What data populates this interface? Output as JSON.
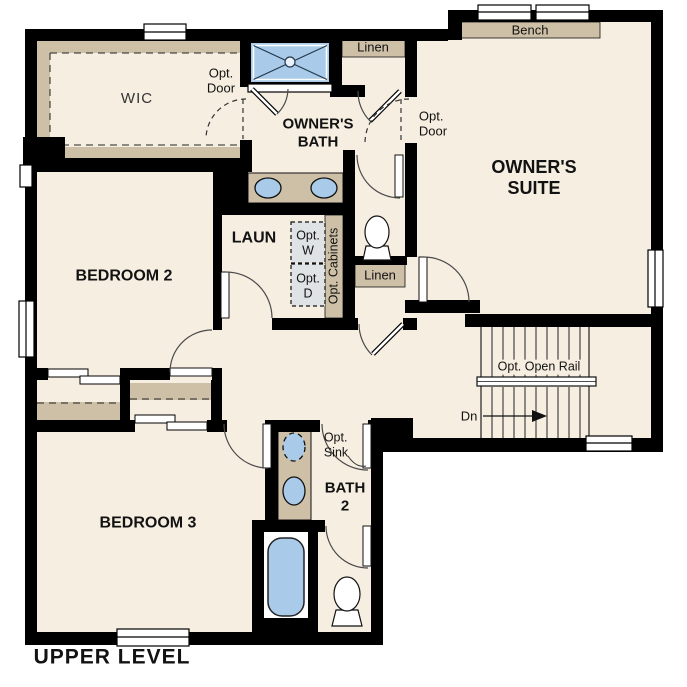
{
  "title": "UPPER LEVEL",
  "colors": {
    "floor": "#f6eee1",
    "wall": "#000000",
    "casework_tan": "#cec0a7",
    "fixture_blue": "#a9cbe9",
    "appliance_gray": "#dfe3e5"
  },
  "rooms": {
    "wic": {
      "label": "WIC"
    },
    "bedroom2": {
      "label": "BEDROOM 2"
    },
    "bedroom3": {
      "label": "BEDROOM 3"
    },
    "owners_bath": {
      "line1": "OWNER'S",
      "line2": "BATH"
    },
    "owners_suite": {
      "line1": "OWNER'S",
      "line2": "SUITE"
    },
    "laundry": {
      "label": "LAUN"
    },
    "bath2": {
      "line1": "BATH",
      "line2": "2"
    }
  },
  "annotations": {
    "bench": "Bench",
    "linen_upper": "Linen",
    "linen_hall": "Linen",
    "opt_door_wic": {
      "line1": "Opt.",
      "line2": "Door"
    },
    "opt_door_suite": {
      "line1": "Opt.",
      "line2": "Door"
    },
    "opt_washer": {
      "line1": "Opt.",
      "line2": "W"
    },
    "opt_dryer": {
      "line1": "Opt.",
      "line2": "D"
    },
    "opt_cabinets": "Opt. Cabinets",
    "opt_sink": {
      "line1": "Opt.",
      "line2": "Sink"
    },
    "opt_open_rail": "Opt. Open Rail",
    "down": "Dn"
  }
}
